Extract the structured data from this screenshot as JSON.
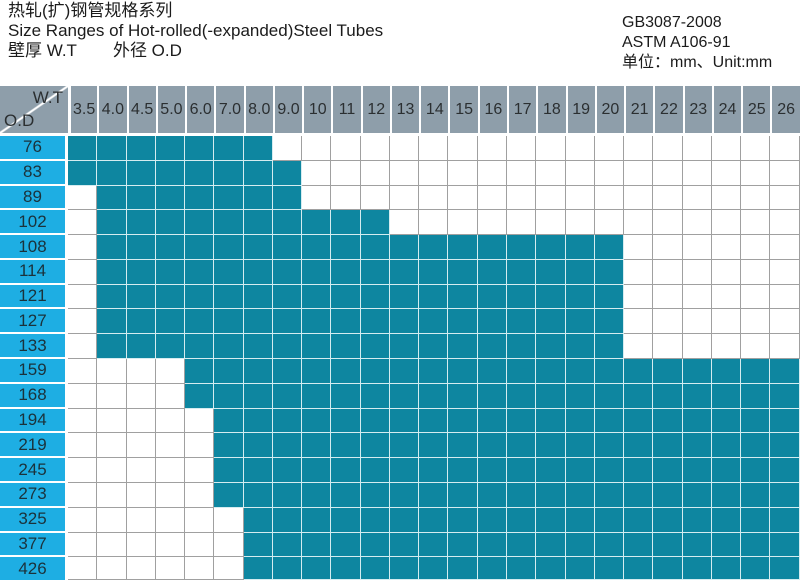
{
  "header": {
    "title_cn": "热轧(扩)钢管规格系列",
    "title_en": "Size Ranges of Hot-rolled(-expanded)Steel Tubes",
    "legend_wt": "壁厚  W.T",
    "legend_od": "外径 O.D",
    "standard_gb": "GB3087-2008",
    "standard_astm": "ASTM A106-91",
    "unit_line": "单位：mm、Unit:mm"
  },
  "table": {
    "corner": {
      "top_right": "W.T",
      "bottom_left": "O.D"
    }
  },
  "colors": {
    "available_fill": "#0e86a0",
    "od_column_fill": "#1eaee3",
    "header_fill": "#8e9eaa",
    "grid_line_empty": "#a0a0a0",
    "grid_line_filled": "#d5ecf0"
  },
  "chart_data": {
    "type": "heatmap",
    "title": "Size Ranges of Hot-rolled(-expanded)Steel Tubes",
    "xlabel": "W.T",
    "ylabel": "O.D",
    "x": [
      "3.5",
      "4.0",
      "4.5",
      "5.0",
      "6.0",
      "7.0",
      "8.0",
      "9.0",
      "10",
      "11",
      "12",
      "13",
      "14",
      "15",
      "16",
      "17",
      "18",
      "19",
      "20",
      "21",
      "22",
      "23",
      "24",
      "25",
      "26"
    ],
    "y": [
      "76",
      "83",
      "89",
      "102",
      "108",
      "114",
      "121",
      "127",
      "133",
      "159",
      "168",
      "194",
      "219",
      "245",
      "273",
      "325",
      "377",
      "426"
    ],
    "matrix": [
      [
        1,
        1,
        1,
        1,
        1,
        1,
        1,
        0,
        0,
        0,
        0,
        0,
        0,
        0,
        0,
        0,
        0,
        0,
        0,
        0,
        0,
        0,
        0,
        0,
        0
      ],
      [
        1,
        1,
        1,
        1,
        1,
        1,
        1,
        1,
        0,
        0,
        0,
        0,
        0,
        0,
        0,
        0,
        0,
        0,
        0,
        0,
        0,
        0,
        0,
        0,
        0
      ],
      [
        0,
        1,
        1,
        1,
        1,
        1,
        1,
        1,
        0,
        0,
        0,
        0,
        0,
        0,
        0,
        0,
        0,
        0,
        0,
        0,
        0,
        0,
        0,
        0,
        0
      ],
      [
        0,
        1,
        1,
        1,
        1,
        1,
        1,
        1,
        1,
        1,
        1,
        0,
        0,
        0,
        0,
        0,
        0,
        0,
        0,
        0,
        0,
        0,
        0,
        0,
        0
      ],
      [
        0,
        1,
        1,
        1,
        1,
        1,
        1,
        1,
        1,
        1,
        1,
        1,
        1,
        1,
        1,
        1,
        1,
        1,
        1,
        0,
        0,
        0,
        0,
        0,
        0
      ],
      [
        0,
        1,
        1,
        1,
        1,
        1,
        1,
        1,
        1,
        1,
        1,
        1,
        1,
        1,
        1,
        1,
        1,
        1,
        1,
        0,
        0,
        0,
        0,
        0,
        0
      ],
      [
        0,
        1,
        1,
        1,
        1,
        1,
        1,
        1,
        1,
        1,
        1,
        1,
        1,
        1,
        1,
        1,
        1,
        1,
        1,
        0,
        0,
        0,
        0,
        0,
        0
      ],
      [
        0,
        1,
        1,
        1,
        1,
        1,
        1,
        1,
        1,
        1,
        1,
        1,
        1,
        1,
        1,
        1,
        1,
        1,
        1,
        0,
        0,
        0,
        0,
        0,
        0
      ],
      [
        0,
        1,
        1,
        1,
        1,
        1,
        1,
        1,
        1,
        1,
        1,
        1,
        1,
        1,
        1,
        1,
        1,
        1,
        1,
        0,
        0,
        0,
        0,
        0,
        0
      ],
      [
        0,
        0,
        0,
        0,
        1,
        1,
        1,
        1,
        1,
        1,
        1,
        1,
        1,
        1,
        1,
        1,
        1,
        1,
        1,
        1,
        1,
        1,
        1,
        1,
        1
      ],
      [
        0,
        0,
        0,
        0,
        1,
        1,
        1,
        1,
        1,
        1,
        1,
        1,
        1,
        1,
        1,
        1,
        1,
        1,
        1,
        1,
        1,
        1,
        1,
        1,
        1
      ],
      [
        0,
        0,
        0,
        0,
        0,
        1,
        1,
        1,
        1,
        1,
        1,
        1,
        1,
        1,
        1,
        1,
        1,
        1,
        1,
        1,
        1,
        1,
        1,
        1,
        1
      ],
      [
        0,
        0,
        0,
        0,
        0,
        1,
        1,
        1,
        1,
        1,
        1,
        1,
        1,
        1,
        1,
        1,
        1,
        1,
        1,
        1,
        1,
        1,
        1,
        1,
        1
      ],
      [
        0,
        0,
        0,
        0,
        0,
        1,
        1,
        1,
        1,
        1,
        1,
        1,
        1,
        1,
        1,
        1,
        1,
        1,
        1,
        1,
        1,
        1,
        1,
        1,
        1
      ],
      [
        0,
        0,
        0,
        0,
        0,
        1,
        1,
        1,
        1,
        1,
        1,
        1,
        1,
        1,
        1,
        1,
        1,
        1,
        1,
        1,
        1,
        1,
        1,
        1,
        1
      ],
      [
        0,
        0,
        0,
        0,
        0,
        0,
        1,
        1,
        1,
        1,
        1,
        1,
        1,
        1,
        1,
        1,
        1,
        1,
        1,
        1,
        1,
        1,
        1,
        1,
        1
      ],
      [
        0,
        0,
        0,
        0,
        0,
        0,
        1,
        1,
        1,
        1,
        1,
        1,
        1,
        1,
        1,
        1,
        1,
        1,
        1,
        1,
        1,
        1,
        1,
        1,
        1
      ],
      [
        0,
        0,
        0,
        0,
        0,
        0,
        1,
        1,
        1,
        1,
        1,
        1,
        1,
        1,
        1,
        1,
        1,
        1,
        1,
        1,
        1,
        1,
        1,
        1,
        1
      ]
    ],
    "grid": true,
    "legend_position": "none"
  }
}
